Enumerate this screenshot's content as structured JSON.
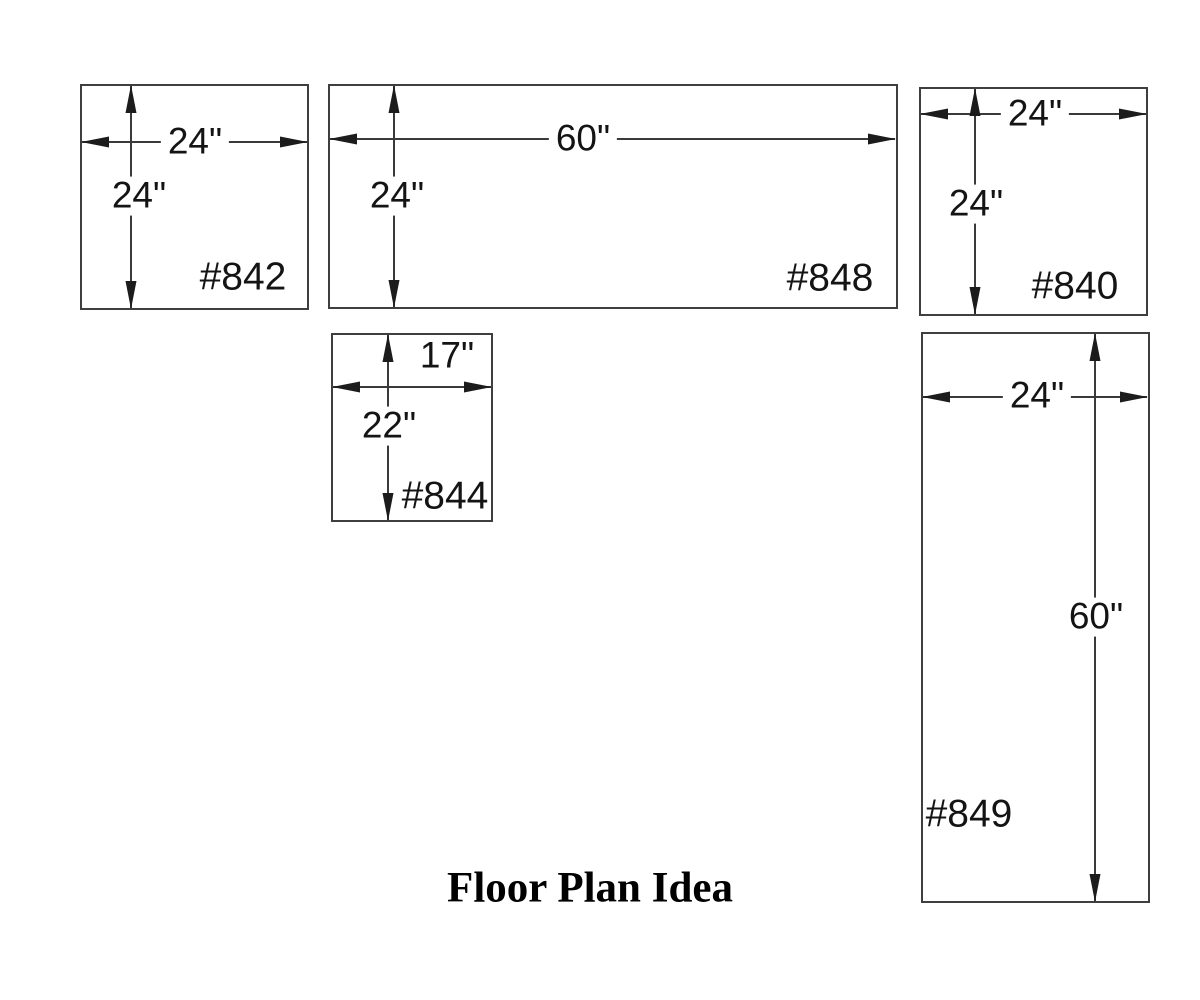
{
  "title": "Floor Plan Idea",
  "units": {
    "u842": {
      "label": "#842",
      "width": "24\"",
      "height": "24\""
    },
    "u848": {
      "label": "#848",
      "width": "60\"",
      "height": "24\""
    },
    "u840": {
      "label": "#840",
      "width": "24\"",
      "height": "24\""
    },
    "u844": {
      "label": "#844",
      "width": "17\"",
      "height": "22\""
    },
    "u849": {
      "label": "#849",
      "width": "24\"",
      "height": "60\""
    }
  },
  "colors": {
    "line": "#3a3a3a",
    "text": "#141414",
    "background": "#ffffff"
  }
}
